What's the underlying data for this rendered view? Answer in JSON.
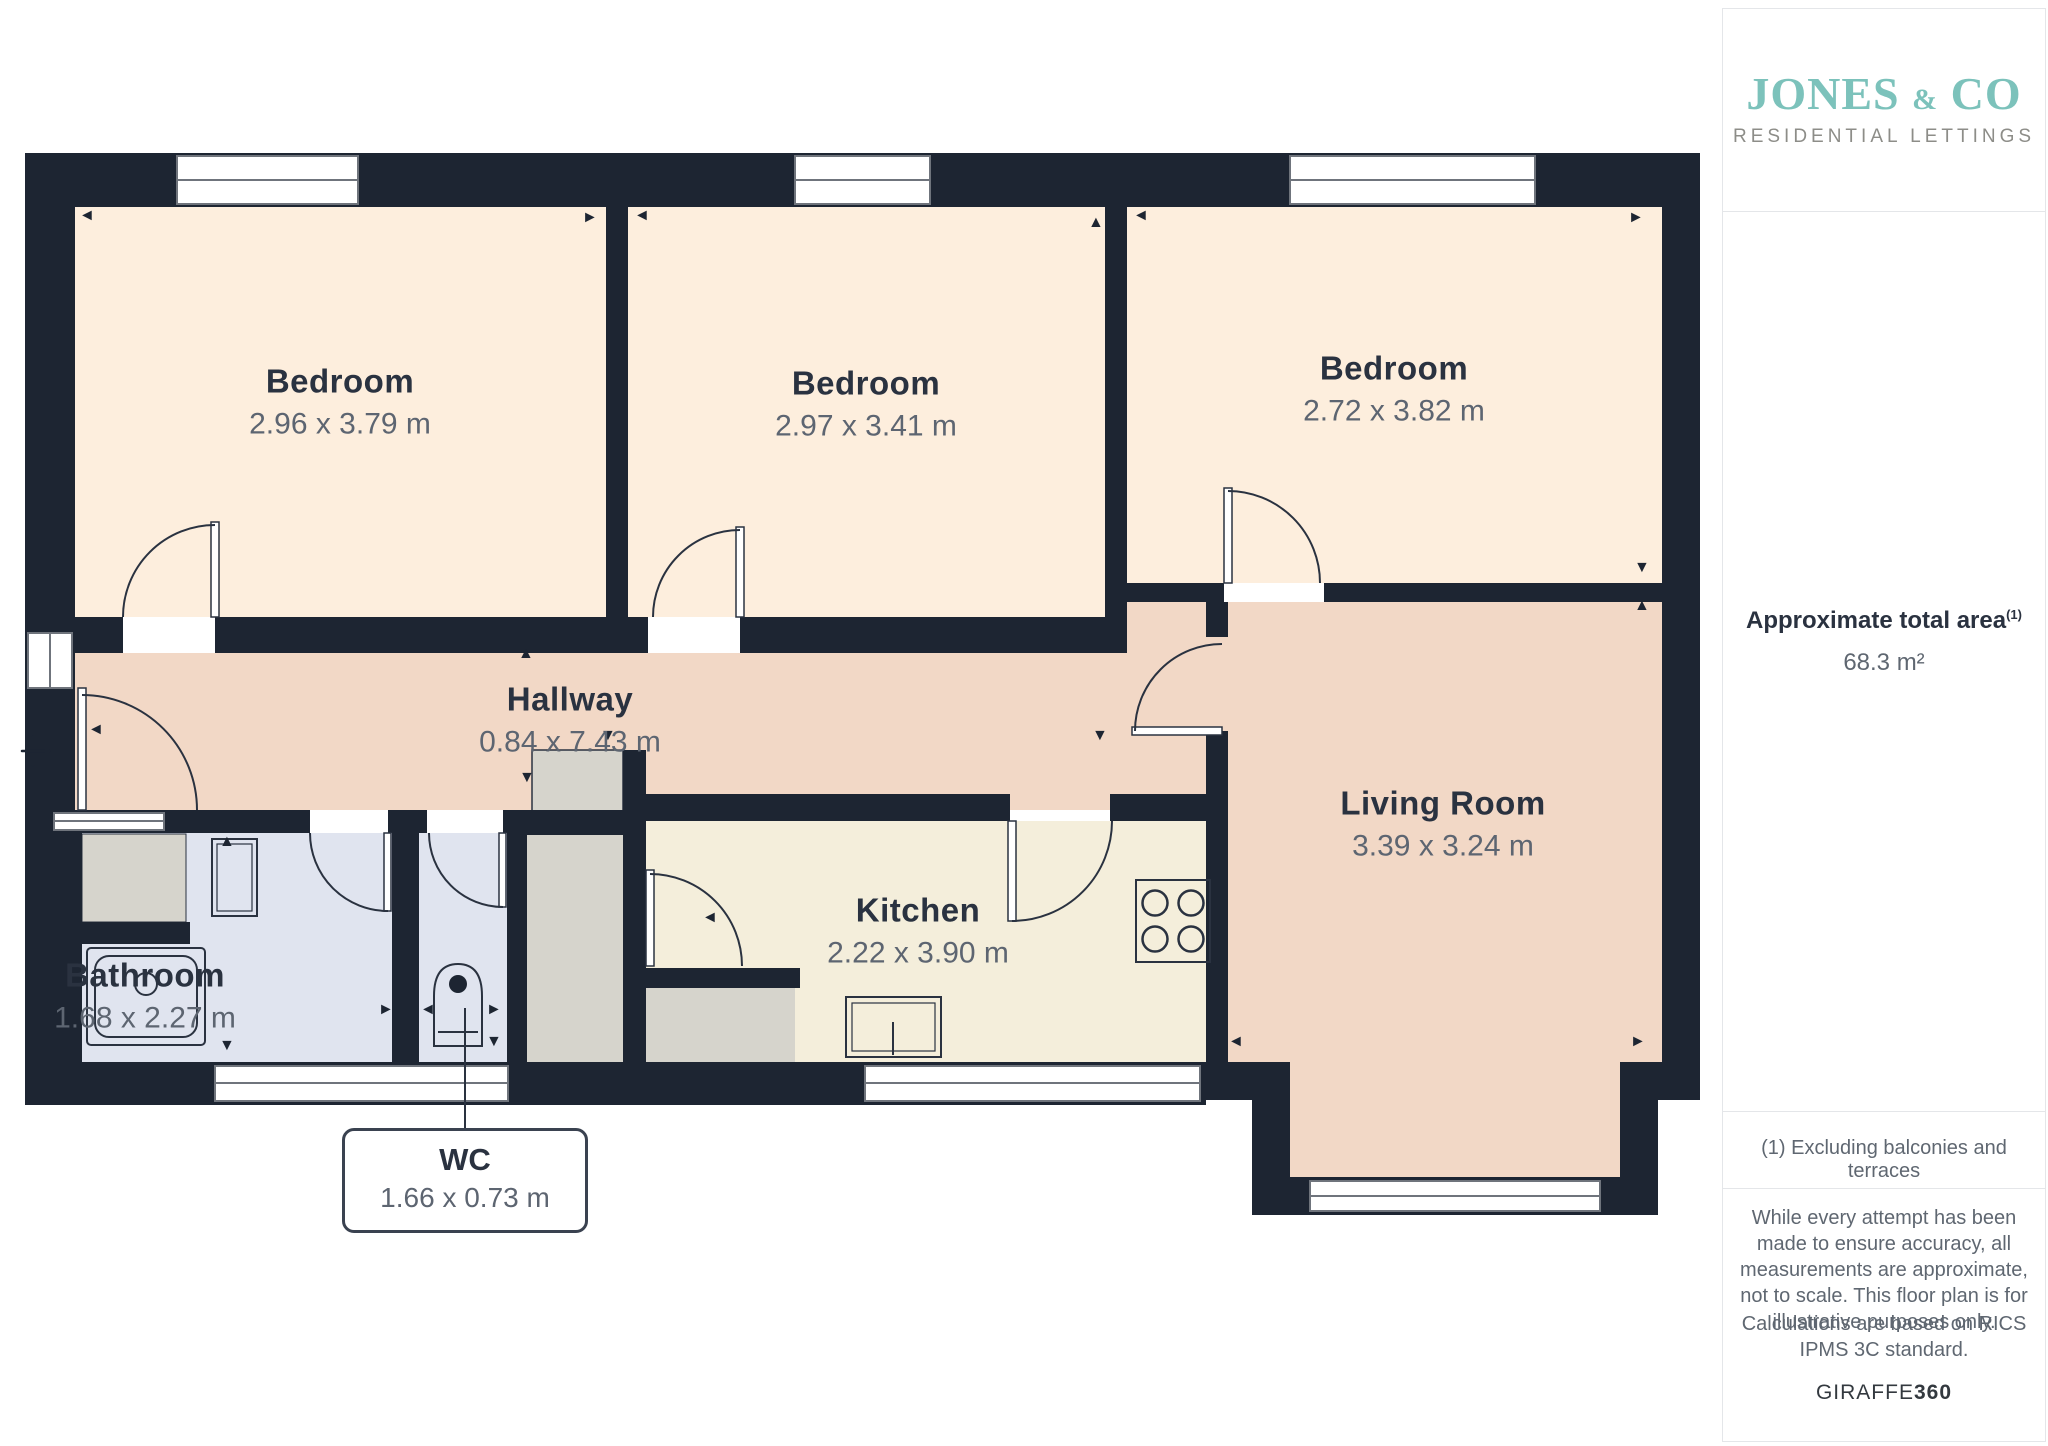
{
  "branding": {
    "logo_word1": "JONES",
    "logo_amp": "&",
    "logo_word2": "CO",
    "logo_subtitle": "RESIDENTIAL LETTINGS"
  },
  "sidebar": {
    "area_label": "Approximate total area",
    "area_ref": "(1)",
    "area_value": "68.3 m²",
    "footnote": "(1) Excluding balconies and terraces",
    "disclaimer": "While every attempt has been made to ensure accuracy, all measurements are approximate, not to scale. This floor plan is for illustrative purposes only.",
    "standard": "Calculations are based on RICS IPMS 3C standard.",
    "brand_giraffe": "GIRAFFE",
    "brand_360": "360"
  },
  "rooms": [
    {
      "name": "Bedroom",
      "dims": "2.96 x 3.79 m"
    },
    {
      "name": "Bedroom",
      "dims": "2.97 x 3.41 m"
    },
    {
      "name": "Bedroom",
      "dims": "2.72 x 3.82 m"
    },
    {
      "name": "Hallway",
      "dims": "0.84 x 7.43 m"
    },
    {
      "name": "Living Room",
      "dims": "3.39 x 3.24 m"
    },
    {
      "name": "Kitchen",
      "dims": "2.22 x 3.90 m"
    },
    {
      "name": "Bathroom",
      "dims": "1.68 x 2.27 m"
    },
    {
      "name": "WC",
      "dims": "1.66 x 0.73 m"
    }
  ],
  "arrows": [
    {
      "g": "◄",
      "x": 79,
      "y": 208
    },
    {
      "g": "►",
      "x": 582,
      "y": 210
    },
    {
      "g": "◄",
      "x": 634,
      "y": 208
    },
    {
      "g": "▲",
      "x": 1088,
      "y": 215
    },
    {
      "g": "◄",
      "x": 1133,
      "y": 208
    },
    {
      "g": "►",
      "x": 1628,
      "y": 210
    },
    {
      "g": "▼",
      "x": 1634,
      "y": 560
    },
    {
      "g": "▲",
      "x": 1634,
      "y": 598
    },
    {
      "g": "◄",
      "x": 1228,
      "y": 1034
    },
    {
      "g": "►",
      "x": 1630,
      "y": 1034
    },
    {
      "g": "▲",
      "x": 518,
      "y": 646
    },
    {
      "g": "▼",
      "x": 519,
      "y": 770
    },
    {
      "g": "▼",
      "x": 600,
      "y": 728
    },
    {
      "g": "▼",
      "x": 1092,
      "y": 728
    },
    {
      "g": "◄",
      "x": 88,
      "y": 722
    },
    {
      "g": "◄",
      "x": 702,
      "y": 910
    },
    {
      "g": "▲",
      "x": 219,
      "y": 834
    },
    {
      "g": "▼",
      "x": 219,
      "y": 1038
    },
    {
      "g": "►",
      "x": 378,
      "y": 1002
    },
    {
      "g": "◄",
      "x": 420,
      "y": 1002
    },
    {
      "g": "►",
      "x": 486,
      "y": 1002
    },
    {
      "g": "▼",
      "x": 486,
      "y": 1034
    }
  ],
  "colors": {
    "wall": "#1d2532",
    "bedroom_fill": "#fdeedd",
    "hall_fill": "#f2d8c6",
    "kitchen_fill": "#f4eedb",
    "bath_fill": "#e0e4ef",
    "closet_fill": "#d6d4cc",
    "accent_teal": "#7cc2bb"
  }
}
